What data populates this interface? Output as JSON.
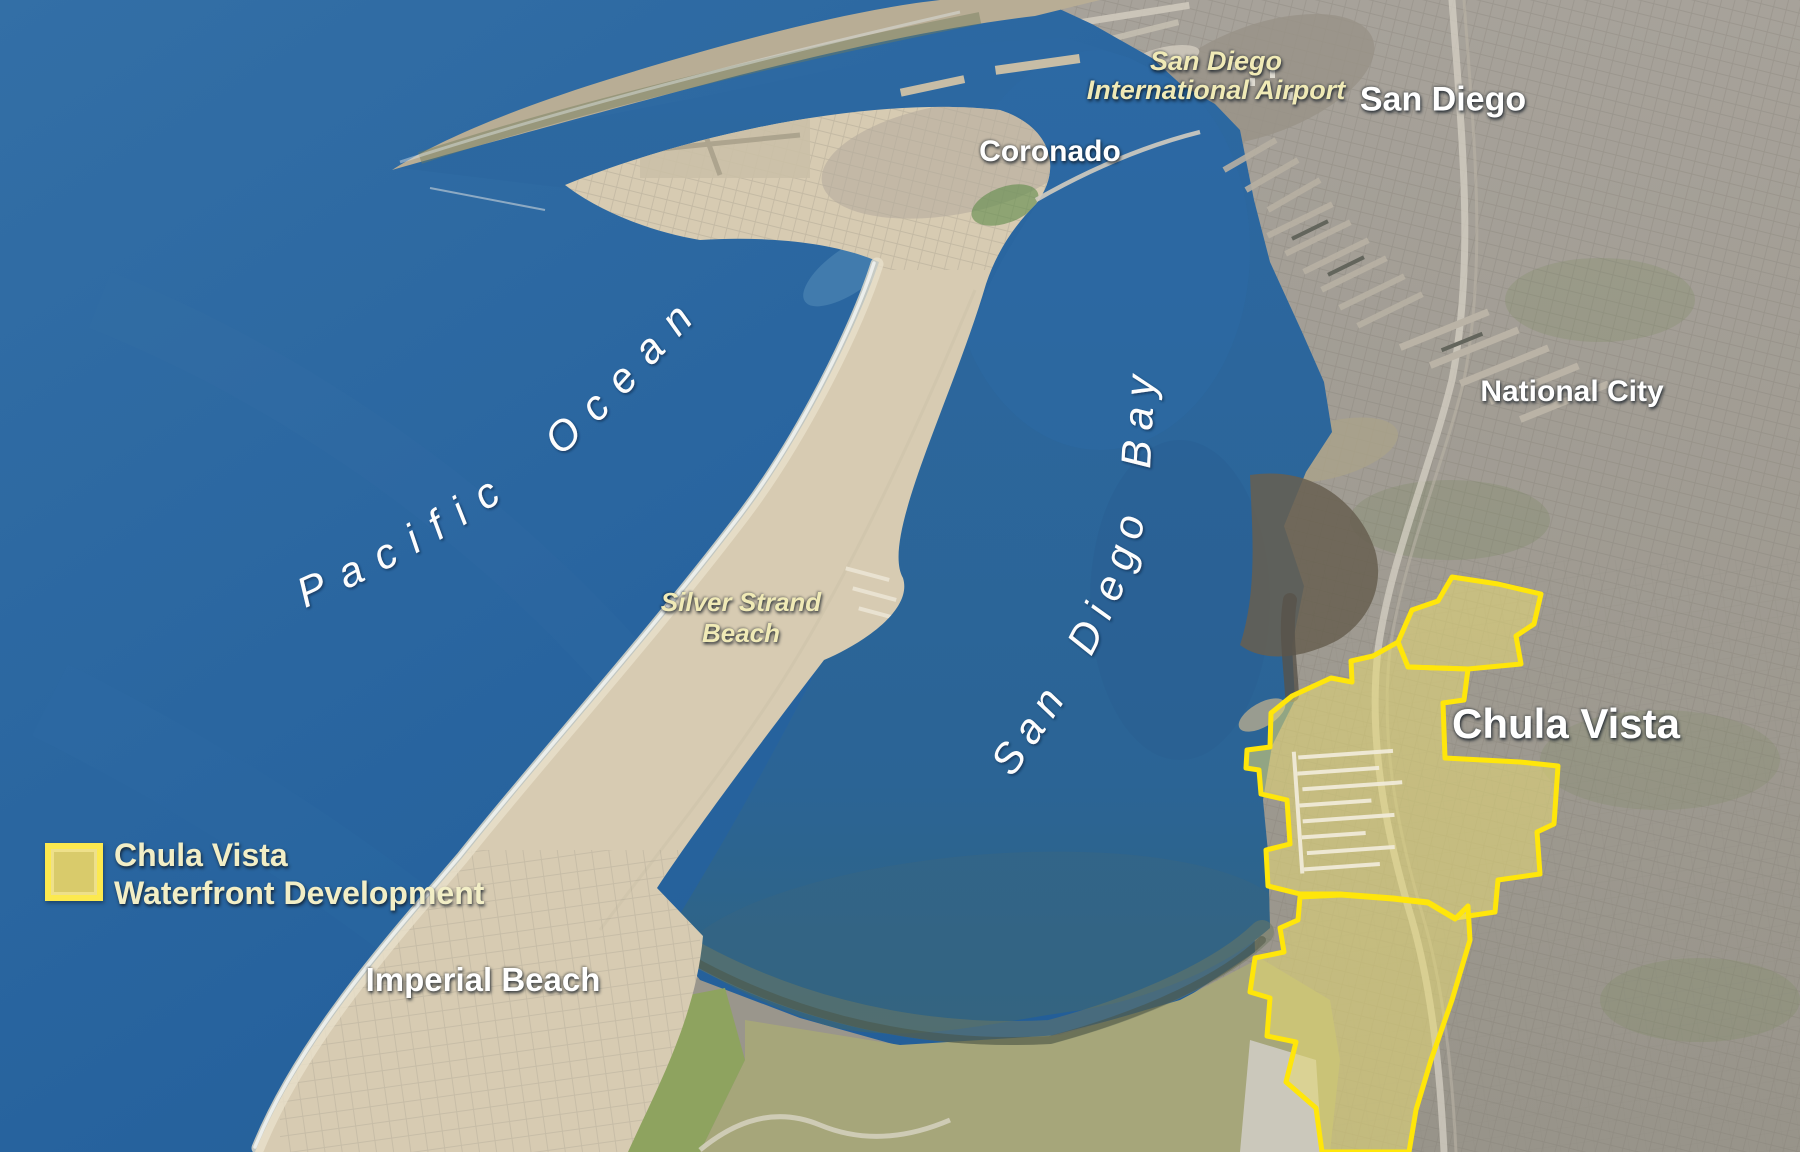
{
  "map": {
    "description": "Aerial photo map of San Diego Bay region highlighting the Chula Vista Waterfront Development"
  },
  "labels": {
    "airport_line1": "San Diego",
    "airport_line2": "International Airport",
    "san_diego": "San Diego",
    "coronado": "Coronado",
    "pacific_ocean": "Pacific Ocean",
    "san_diego_bay": "San Diego Bay",
    "national_city": "National City",
    "silver_strand_line1": "Silver Strand",
    "silver_strand_line2": "Beach",
    "chula_vista": "Chula Vista",
    "imperial_beach": "Imperial Beach"
  },
  "legend": {
    "line1": "Chula Vista",
    "line2": "Waterfront Development",
    "swatch_border": "#fce94f",
    "swatch_fill": "#d9cb6b"
  },
  "colors": {
    "ocean": "#27639e",
    "bay": "#2c68a2",
    "sand": "#d7cbb2",
    "urban": "#a29d94",
    "fields": "#a6a67a",
    "highlight_outline": "#ffe60a",
    "highlight_fill": "#e8db74",
    "label_white": "#ffffff",
    "label_pale_yellow": "#f0eab6"
  }
}
